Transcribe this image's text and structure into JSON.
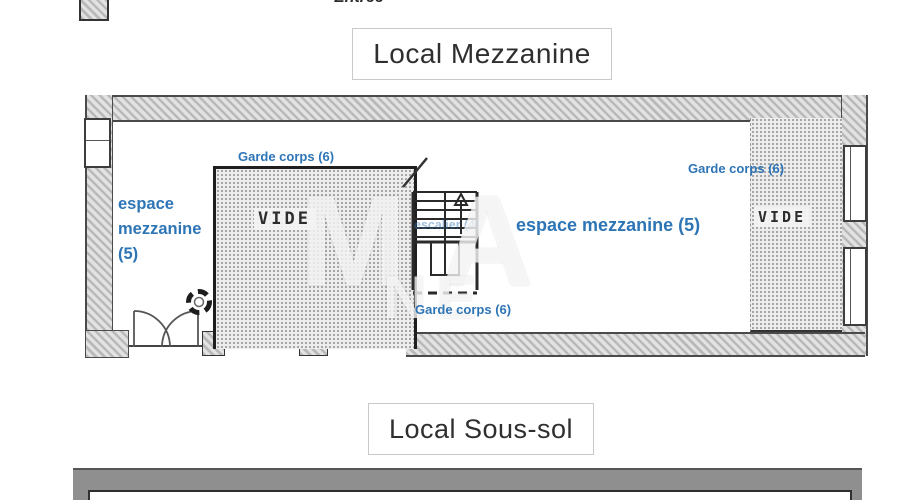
{
  "colors": {
    "accent_blue": "#2e75b6",
    "wall_gray": "#c6c6c6",
    "line_dark": "#333333"
  },
  "header": {
    "entree_label": "Entrée"
  },
  "mezzanine": {
    "title": "Local Mezzanine",
    "garde_corps_top": "Garde corps (6)",
    "garde_corps_bottom": "Garde corps (6)",
    "garde_corps_right": "Garde corps (6)",
    "espace_left": {
      "line1": "espace",
      "line2": "mezzanine",
      "line3": "(5)"
    },
    "espace_center": "espace mezzanine (5)",
    "escalier_label": "escalier (4)",
    "vide_left_label": "VIDE",
    "vide_right_label": "VIDE"
  },
  "soussol": {
    "title": "Local Sous-sol"
  },
  "watermark": {
    "line1": "MA",
    "line2": "NE"
  }
}
